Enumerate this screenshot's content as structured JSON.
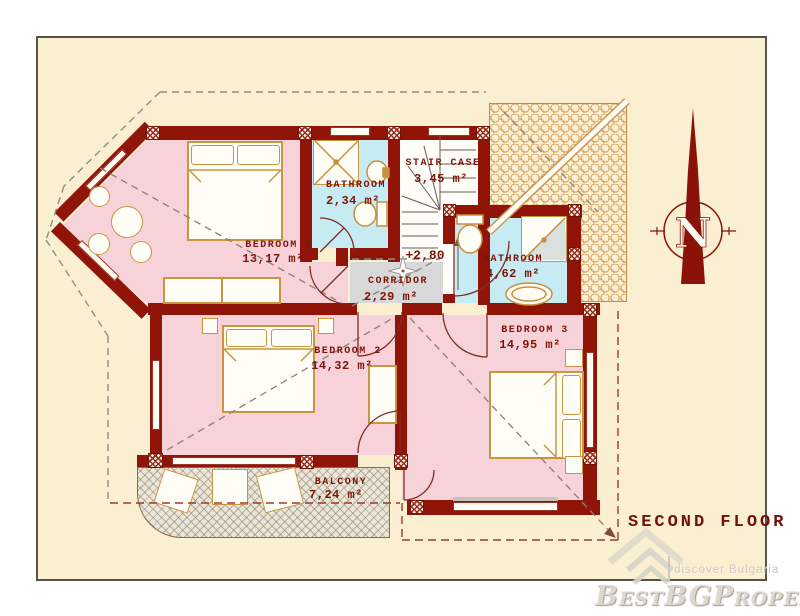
{
  "floorplan": {
    "title": "SECOND FLOOR",
    "elevation": "+2,80",
    "compass_letter": "N",
    "rooms": [
      {
        "id": "bedroom-1",
        "name": "BEDROOM 1",
        "area": "13,17 m²"
      },
      {
        "id": "bathroom-1",
        "name": "BATHROOM",
        "area": "2,34 m²"
      },
      {
        "id": "staircase",
        "name": "STAIR CASE",
        "area": "3,45 m²"
      },
      {
        "id": "bathroom-2",
        "name": "BATHROOM",
        "area": "4,62 m²"
      },
      {
        "id": "corridor",
        "name": "CORRIDOR",
        "area": "2,29 m²"
      },
      {
        "id": "bedroom-2",
        "name": "BEDROOM 2",
        "area": "14,32 m²"
      },
      {
        "id": "bedroom-3",
        "name": "BEDROOM 3",
        "area": "14,95 m²"
      },
      {
        "id": "balcony",
        "name": "BALCONY",
        "area": "7,24 m²"
      }
    ]
  },
  "watermark": {
    "brand": "BestBGProperties",
    "tagline": "discover Bulgaria"
  },
  "icons": {
    "compass": "north-compass-icon",
    "corridor_star": "corridor-star-icon",
    "watermark_logo": "watermark-roof-icon"
  },
  "colors": {
    "wall": "#911408",
    "bedroom_fill": "#F8D2D9",
    "bathroom_fill": "#C7EBF3",
    "corridor_fill": "#D8D8D8",
    "floor_background": "#FAEFD1",
    "label_text": "#7D150B",
    "roof_tile": "#C8823D"
  }
}
